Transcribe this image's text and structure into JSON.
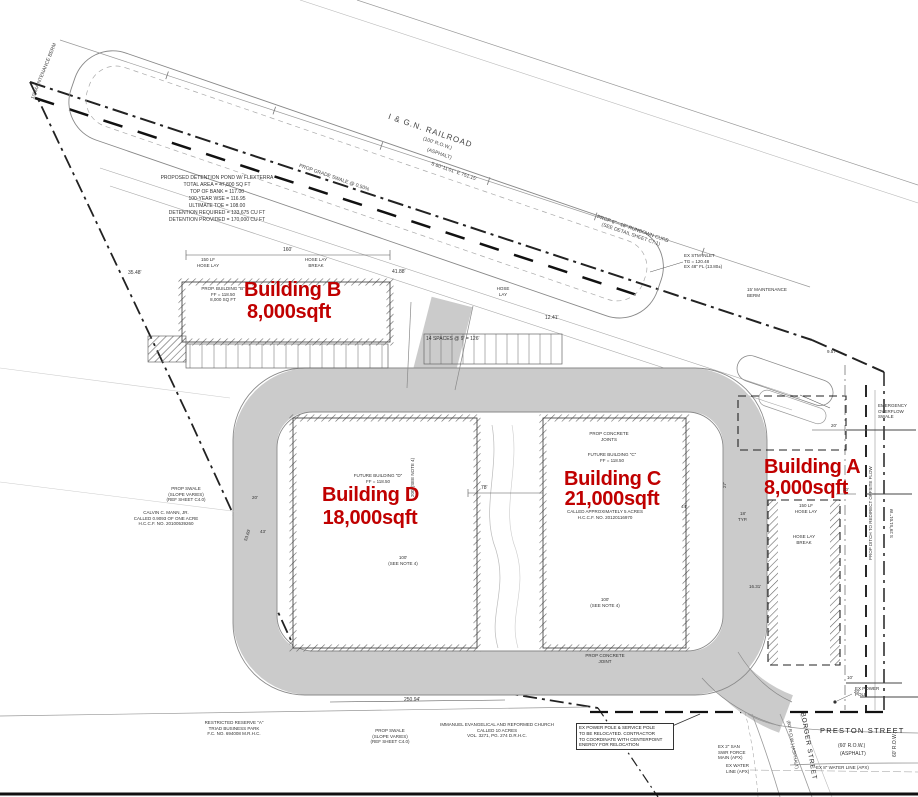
{
  "colors": {
    "red": "#c00000",
    "road": "#cbcbcb"
  },
  "railroad": {
    "name": "I & G.N. RAILROAD",
    "row": "(100' R.O.W.)",
    "surface": "(ASPHALT)",
    "bearing": "S 60°11'01\" E    751.15'"
  },
  "pond_note": [
    "PROPOSED DETENTION POND W/ FLEXTERRA",
    "TOTAL AREA = 47,800 SQ FT",
    "TOP OF BANK = 117.00",
    "100-YEAR WSE = 116.95",
    "ULTIMATE TOE = 108.00",
    "DETENTION REQUIRED = 133,675 CU FT",
    "DETENTION PROVIDED = 170,000 CU FT"
  ],
  "buildings": {
    "b": {
      "label": "Building B",
      "area": "8,000sqft",
      "note": [
        "PROP. BUILDING \"B\"",
        "FF = 118.50",
        "8,000 SQ FT"
      ]
    },
    "d": {
      "label": "Building D",
      "area": "18,000sqft",
      "note": [
        "FUTURE BUILDING \"D\"",
        "FF = 118.50"
      ]
    },
    "c": {
      "label": "Building C",
      "area": "21,000sqft",
      "note": [
        "FUTURE BUILDING \"C\"",
        "FF = 118.50"
      ],
      "parcel": [
        "CALLED APPROXIMATELY 5 ACRES",
        "H.C.C.F. NO. 20120116970"
      ]
    },
    "a": {
      "label": "Building A",
      "area": "8,000sqft"
    }
  },
  "annotations": {
    "maintenance_berm_top": "10' MAINTENANCE BERM",
    "maintenance_berm_right": [
      "15' MAINTENANCE",
      "BERM"
    ],
    "grade_swale": "PROP GRADE SWALE @ 0.50%",
    "rundown_curb": [
      "PROP 6\" - 18\" RUNDOWN CURB",
      "(SEE DETAIL SHEET C7.1)"
    ],
    "ex_stm_inlet": [
      "EX STM INLET",
      "TG = 120.48",
      "EX 48\" FL (13.80±)"
    ],
    "emergency_swale": [
      "EMERGENCY",
      "OVERFLOW",
      "SWALE"
    ],
    "prop_ditch": "PROP DITCH TO REDIRECT OFFSITE FLOW",
    "bearing_east": "S 29°51'01\" W",
    "prop_concrete_joints": [
      "PROP CONCRETE",
      "JOINTS"
    ],
    "prop_concrete_joint": [
      "PROP CONCRETE",
      "JOINT"
    ],
    "see_note_d": [
      "100'",
      "(SEE NOTE 4)"
    ],
    "see_note_c": [
      "100'",
      "(SEE NOTE 4)"
    ],
    "see_note_200": "200' (SEE NOTE 4)",
    "parking": "14 SPACES @ 9' = 126'",
    "hose_150": [
      "150 LF",
      "HOSE LAY"
    ],
    "hose_break": [
      "HOSE LAY",
      "BREAK"
    ],
    "hose_lay": [
      "HOSE",
      "LAY"
    ],
    "power_pole_note": [
      "EX POWER POLE & SERVICE POLE",
      "TO BE RELOCATED. CONTRACTOR",
      "TO COORDINATE WITH CENTERPOINT",
      "ENERGY FOR RELOCATION"
    ],
    "ex_power_pole": [
      "EX POWER",
      "POLE"
    ],
    "san_swr": [
      "EX 2\" SAN",
      "SWR FORCE",
      "MAIN (APX)"
    ],
    "ex_water": [
      "EX WATER",
      "LINE (APX)"
    ],
    "ex8_water": "EX 8\" WATER LINE (APX)",
    "church": [
      "IMMANUEL EVANGELICAL AND REFORMED CHURCH",
      "CALLED 10 ACRES",
      "VOL. 3271, PG. 274 D.R.H.C."
    ],
    "reserve": [
      "RESTRICTED RESERVE \"A\"",
      "TRIAD BUSINESS PARK",
      "F.C. NO. 694008 M.R.H.C."
    ],
    "swale_note": [
      "PROP SWALE",
      "(SLOPE VARIES)",
      "(REF SHEET C4.0)"
    ],
    "mann": [
      "CALVIN C. MANN, JR.",
      "CALLED 0.9093 OF ONE ACRE",
      "H.C.C.F. NO. 20100539260"
    ]
  },
  "streets": {
    "preston": {
      "name": "PRESTON STREET",
      "row": "(60' R.O.W.)",
      "surface": "(ASPHALT)"
    },
    "borger": {
      "name": "BORGER STREET",
      "row": "(60' R.O.W.) (ASPHALT)"
    },
    "row_label": "60' R.O.W."
  },
  "dimensions": {
    "d35": "35.48'",
    "d41": "41.88'",
    "d160": "160'",
    "d12": "12.41'",
    "d78": "78'",
    "d250": "250.94'",
    "d53": "53.60'",
    "d43": "43'",
    "d20a": "20'",
    "d20b": "20'",
    "d10a": "10'",
    "d16": "16.31'",
    "d9": "9.57'",
    "d10b": "10'",
    "d20c": "20'",
    "d18": "18'",
    "dtyp": "TYP.",
    "d44": "44'",
    "d27": "27'"
  }
}
